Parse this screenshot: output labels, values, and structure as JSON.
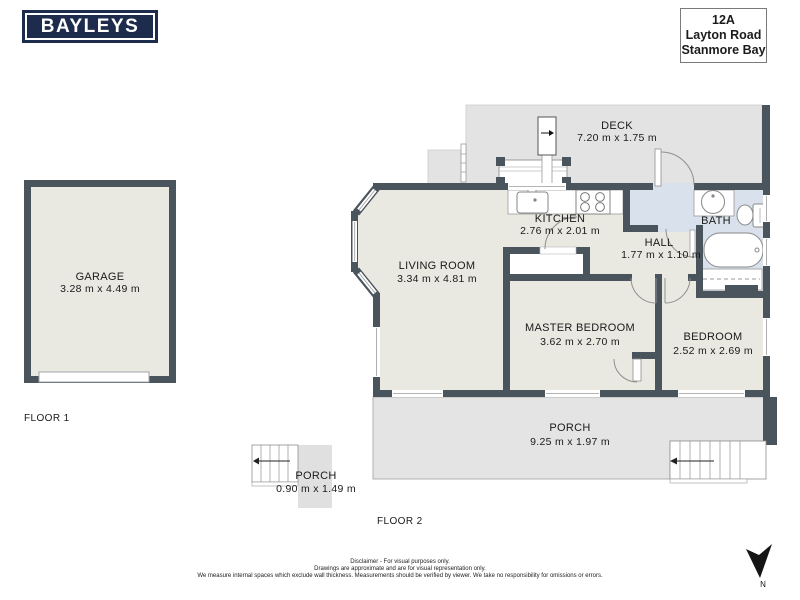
{
  "branding": {
    "logo_text": "BAYLEYS"
  },
  "address": {
    "line1": "12A",
    "line2": "Layton Road",
    "line3": "Stanmore Bay"
  },
  "floor_labels": {
    "floor1": "FLOOR 1",
    "floor2": "FLOOR 2"
  },
  "rooms": {
    "garage": {
      "name": "GARAGE",
      "dims": "3.28 m x 4.49 m",
      "floor": "FLOOR 1"
    },
    "porch1": {
      "name": "PORCH",
      "dims": "0.90 m x 1.49 m",
      "floor": "FLOOR 1"
    },
    "deck": {
      "name": "DECK",
      "dims": "7.20 m x 1.75 m",
      "floor": "FLOOR 2"
    },
    "kitchen": {
      "name": "KITCHEN",
      "dims": "2.76 m x 2.01 m",
      "floor": "FLOOR 2"
    },
    "living_room": {
      "name": "LIVING ROOM",
      "dims": "3.34 m x 4.81 m",
      "floor": "FLOOR 2"
    },
    "hall": {
      "name": "HALL",
      "dims": "1.77 m x 1.10 m",
      "floor": "FLOOR 2"
    },
    "bath": {
      "name": "BATH",
      "floor": "FLOOR 2"
    },
    "master_bedroom": {
      "name": "MASTER BEDROOM",
      "dims": "3.62 m x 2.70 m",
      "floor": "FLOOR 2"
    },
    "bedroom": {
      "name": "BEDROOM",
      "dims": "2.52 m x 2.69 m",
      "floor": "FLOOR 2"
    },
    "porch2": {
      "name": "PORCH",
      "dims": "9.25 m x 1.97 m",
      "floor": "FLOOR 2"
    }
  },
  "compass": {
    "label": "N"
  },
  "disclaimer": {
    "line1": "Disclaimer - For visual purposes only.",
    "line2": "Drawings are approximate and are for visual representation only.",
    "line3": "We measure internal spaces which exclude wall thickness. Measurements should be verified by viewer. We take no responsibility for omissions or errors."
  },
  "colors": {
    "wall": "#4a545c",
    "room_fill": "#e9e8e1",
    "outdoor_fill": "#e3e3e3",
    "bath_fill": "#d9e2ec",
    "logo_bg": "#1d2b4c"
  }
}
